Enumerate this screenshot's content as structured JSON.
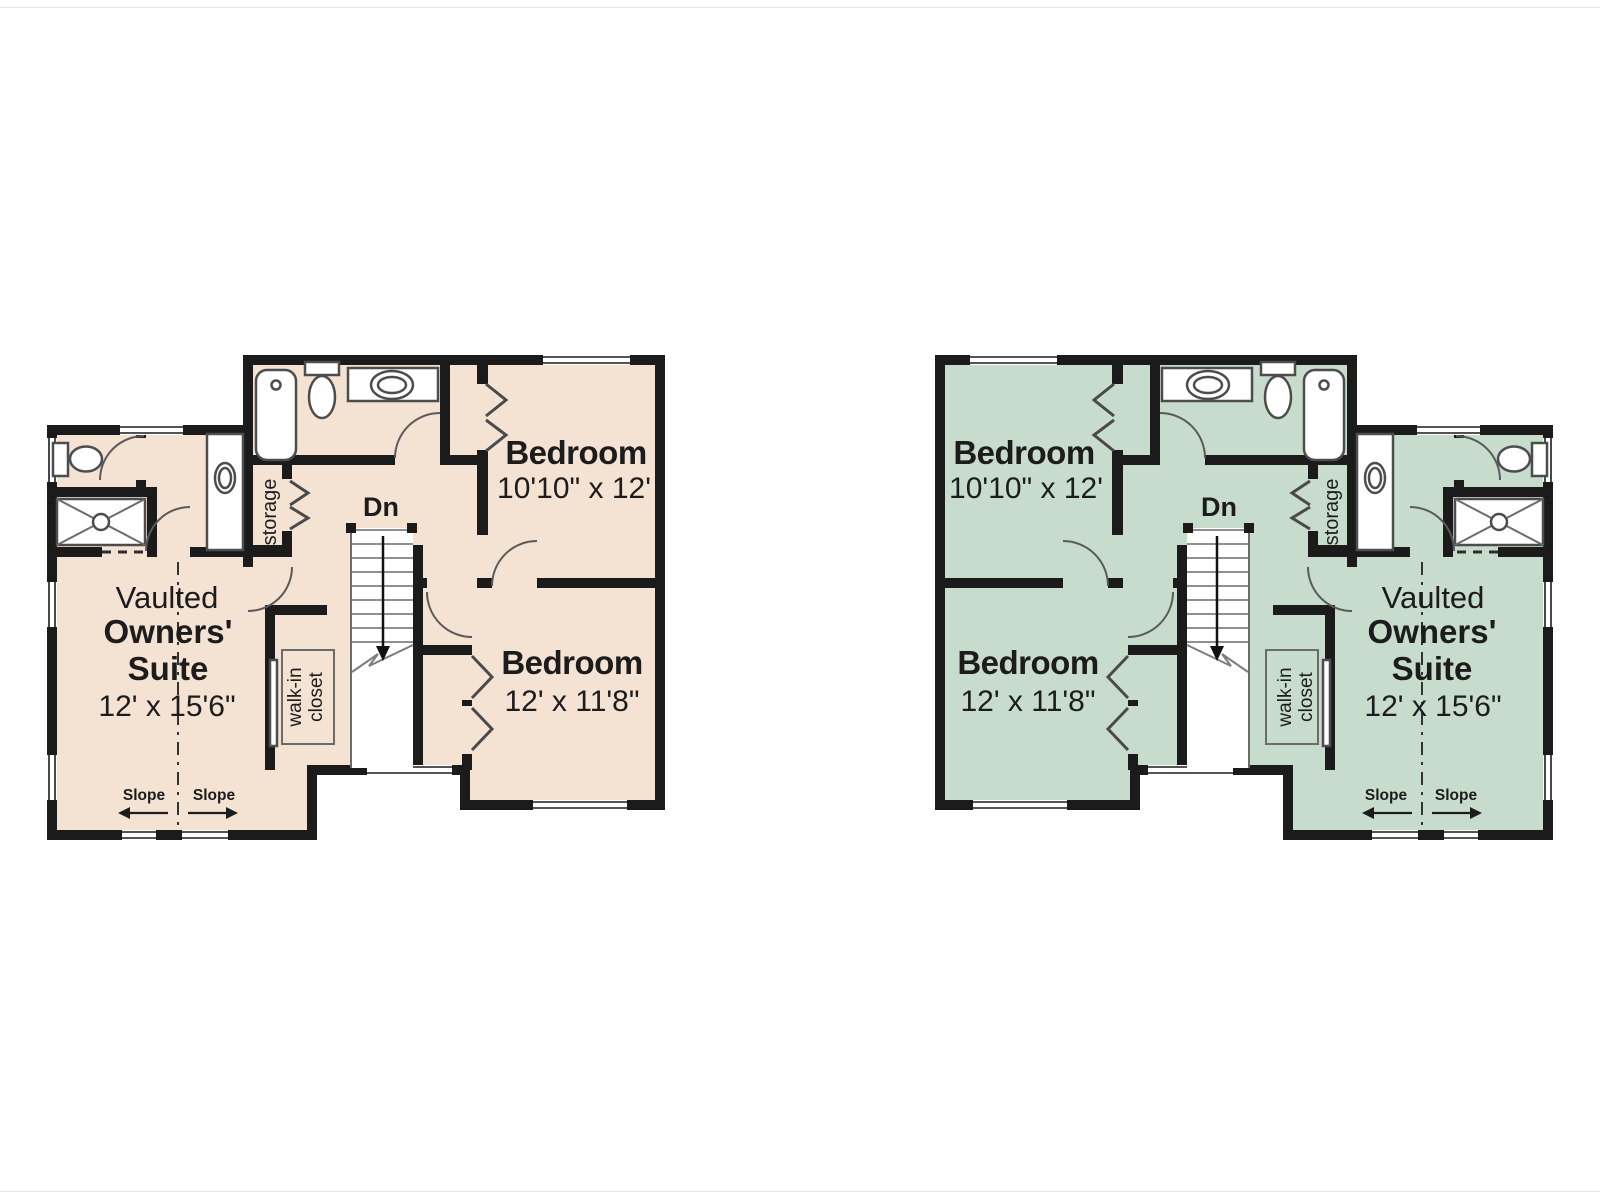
{
  "colors": {
    "left_floor": "#f4e2d3",
    "right_floor": "#c8dccd",
    "wall": "#1b1b1b"
  },
  "labels": {
    "bedroom_top": {
      "name": "Bedroom",
      "dims": "10'10\" x 12'"
    },
    "bedroom_bottom": {
      "name": "Bedroom",
      "dims": "12' x 11'8\""
    },
    "suite": {
      "line1": "Vaulted",
      "line2": "Owners'",
      "line3": "Suite",
      "dims": "12' x 15'6\""
    },
    "stairs_down": "Dn",
    "storage": "storage",
    "walk_in_closet": {
      "line1": "walk-in",
      "line2": "closet"
    },
    "slope": "Slope"
  },
  "plans": [
    {
      "id": "left-floor-plan",
      "scheme": "tan"
    },
    {
      "id": "right-floor-plan",
      "scheme": "green"
    }
  ]
}
